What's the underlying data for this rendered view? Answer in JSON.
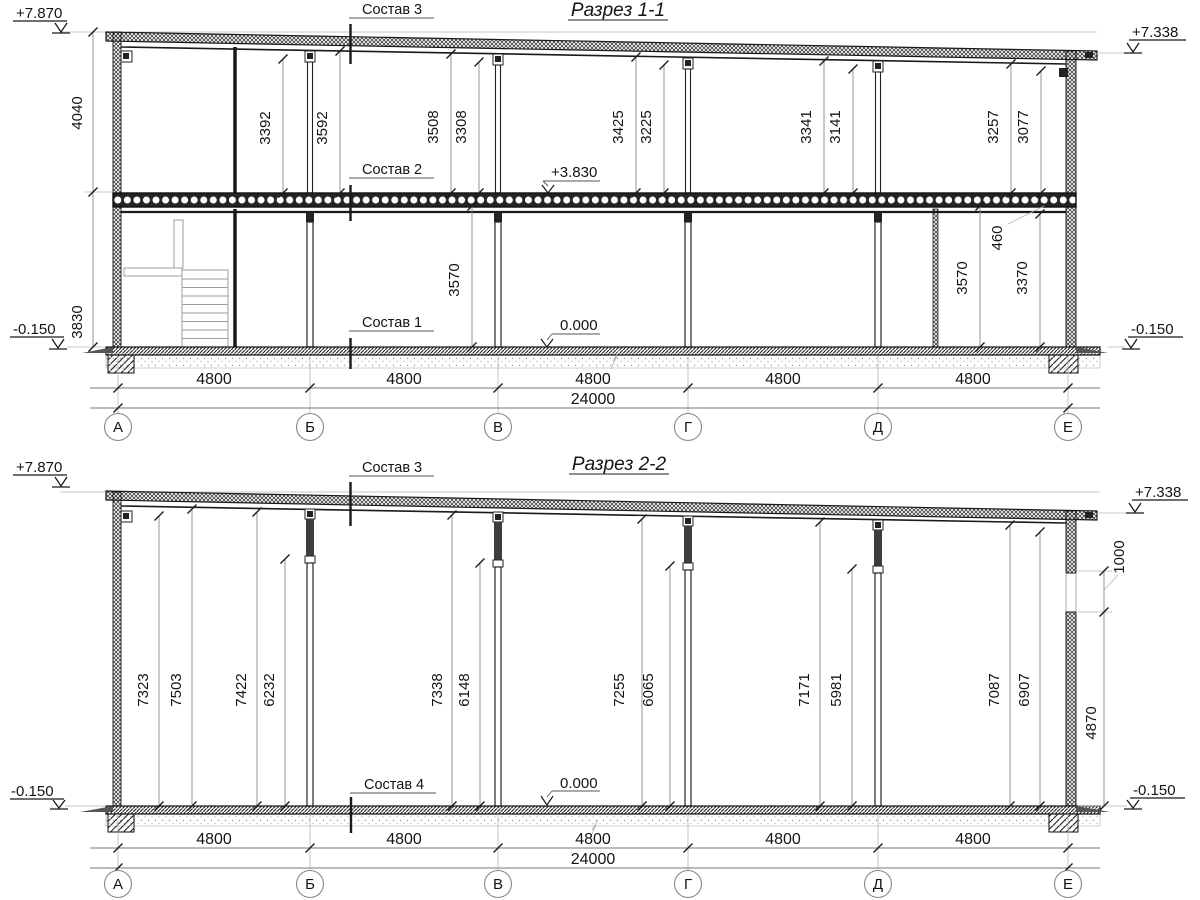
{
  "s1": {
    "title": "Разрез 1-1",
    "elev": {
      "tl": "+7.870",
      "tr": "+7.338",
      "bl": "-0.150",
      "br": "-0.150",
      "mid": "+3.830",
      "zero": "0.000"
    },
    "notes": {
      "roof": "Состав 3",
      "floor": "Состав 2",
      "ground": "Состав 1"
    },
    "left": {
      "top": "4040",
      "bottom": "3830"
    },
    "upper": [
      "3392",
      "3592",
      "3508",
      "3308",
      "3425",
      "3225",
      "3341",
      "3141",
      "3257",
      "3077"
    ],
    "lower": [
      "3570",
      "460",
      "3570",
      "3370"
    ],
    "bays": [
      "4800",
      "4800",
      "4800",
      "4800",
      "4800"
    ],
    "total": "24000",
    "axes": [
      "А",
      "Б",
      "В",
      "Г",
      "Д",
      "Е"
    ]
  },
  "s2": {
    "title": "Разрез 2-2",
    "elev": {
      "tl": "+7.870",
      "tr": "+7.338",
      "bl": "-0.150",
      "br": "-0.150",
      "zero": "0.000"
    },
    "notes": {
      "roof": "Состав 3",
      "floor": "Состав 4"
    },
    "heights": [
      "7323",
      "7503",
      "7422",
      "6232",
      "7338",
      "6148",
      "7255",
      "6065",
      "7171",
      "5981",
      "7087",
      "6907"
    ],
    "window": "1000",
    "wall_bottom": "4870",
    "bays": [
      "4800",
      "4800",
      "4800",
      "4800",
      "4800"
    ],
    "total": "24000",
    "axes": [
      "А",
      "Б",
      "В",
      "Г",
      "Д",
      "Е"
    ]
  }
}
